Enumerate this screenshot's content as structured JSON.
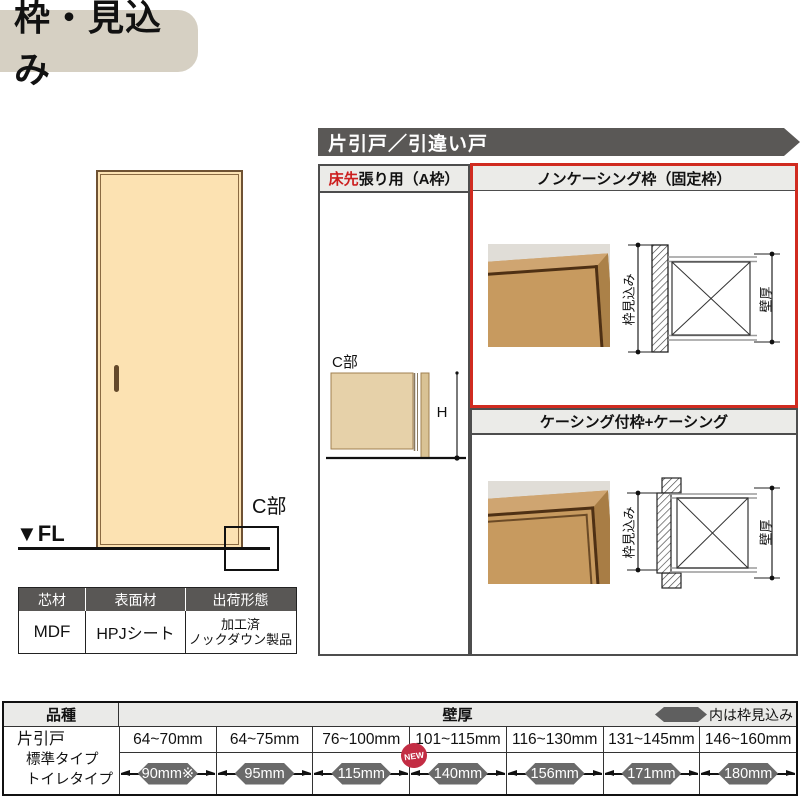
{
  "page_title": "枠・見込み",
  "door_figure": {
    "fl_label": "▼FL",
    "c_section_label": "C部"
  },
  "spec_table": {
    "headers": [
      "芯材",
      "表面材",
      "出荷形態"
    ],
    "values": [
      "MDF",
      "HPJシート",
      "加工済\nノックダウン製品"
    ]
  },
  "banner": {
    "title": "片引戸／引違い戸"
  },
  "sections": {
    "floor_first": {
      "title_highlight": "床先",
      "title_rest": "張り用（A枠）",
      "c_label": "C部",
      "height_label": "H"
    },
    "non_casing": {
      "title": "ノンケーシング枠（固定枠）",
      "frame_depth_label": "枠見込み",
      "wall_thickness_label": "壁厚"
    },
    "casing": {
      "title": "ケーシング付枠+ケーシング",
      "frame_depth_label": "枠見込み",
      "wall_thickness_label": "壁厚"
    }
  },
  "bottom_table": {
    "product_header": "品種",
    "wall_header": "壁厚",
    "legend_label": "内は枠見込み",
    "product_lines": [
      "片引戸",
      "標準タイプ",
      "トイレタイプ"
    ],
    "new_label": "NEW",
    "columns": [
      {
        "wall_range": "64~70mm",
        "frame_depth": "90mm※"
      },
      {
        "wall_range": "64~75mm",
        "frame_depth": "95mm"
      },
      {
        "wall_range": "76~100mm",
        "frame_depth": "115mm"
      },
      {
        "wall_range": "101~115mm",
        "frame_depth": "140mm"
      },
      {
        "wall_range": "116~130mm",
        "frame_depth": "156mm"
      },
      {
        "wall_range": "131~145mm",
        "frame_depth": "171mm"
      },
      {
        "wall_range": "146~160mm",
        "frame_depth": "180mm"
      }
    ]
  },
  "colors": {
    "accent_red": "#d02b20",
    "header_gray": "#5a5856",
    "section_header_bg": "#ebebe8",
    "badge_gray": "#6a6a6a",
    "new_red": "#c32d44",
    "door_fill": "#fce2b2",
    "wood": "#c79a5f",
    "title_bg": "#d6d0c3"
  }
}
